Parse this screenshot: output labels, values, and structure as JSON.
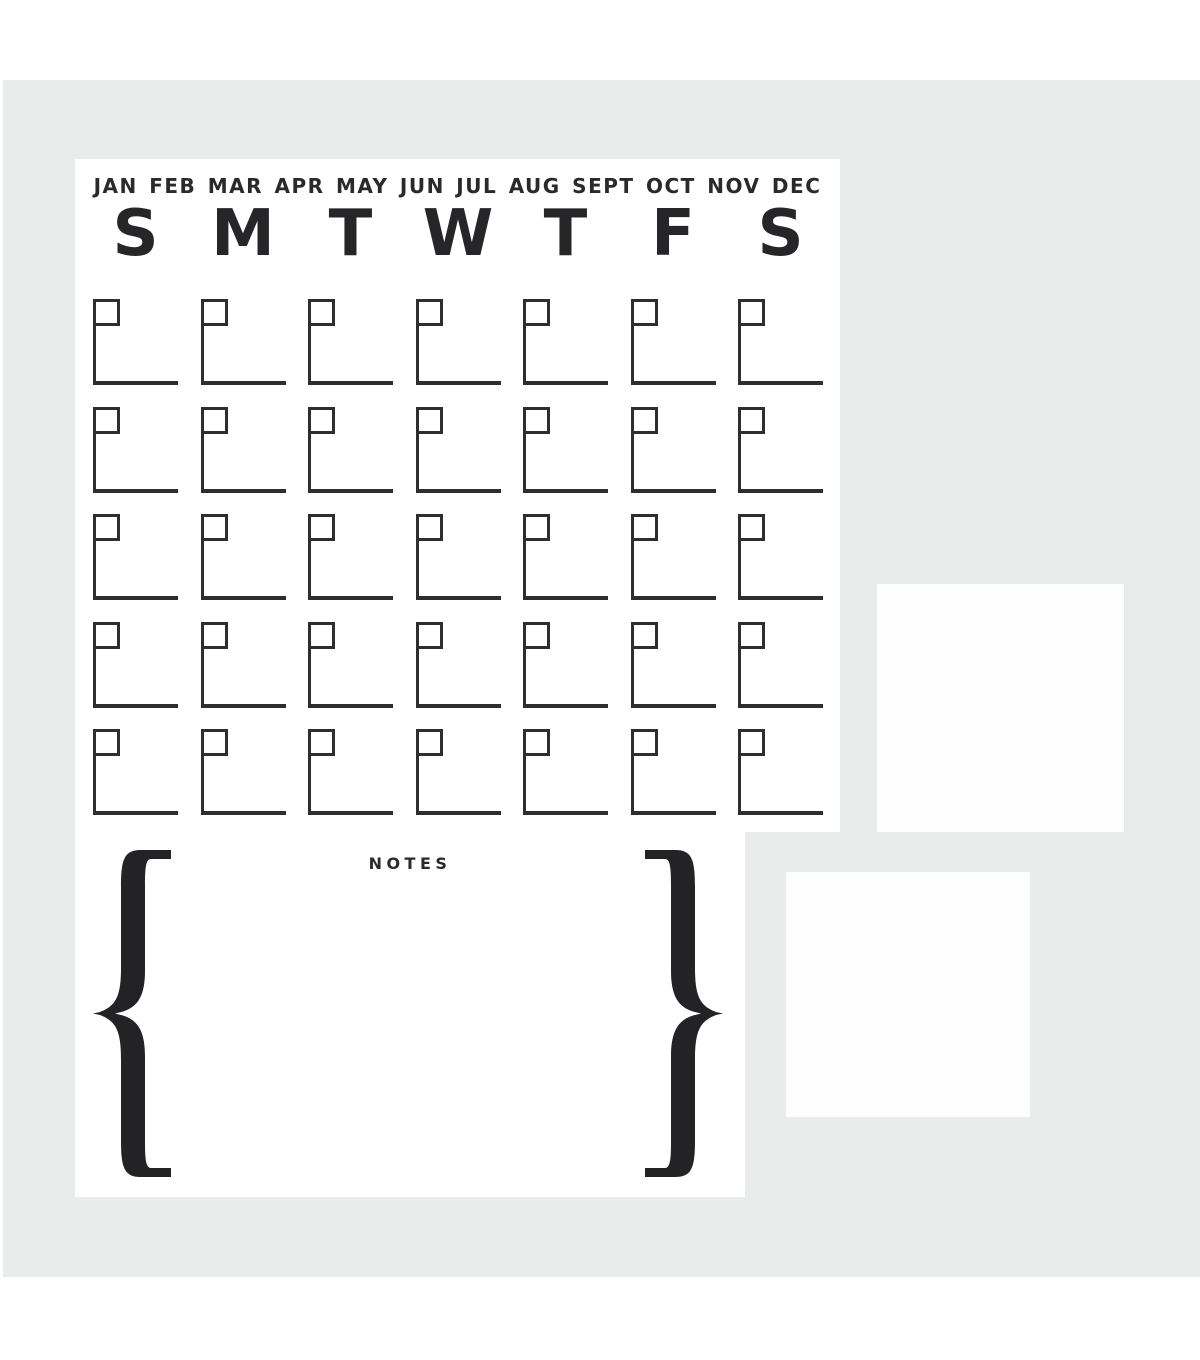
{
  "page": {
    "background_color": "#ffffff",
    "backdrop_color": "#eaecec",
    "ink_color": "#2e2d2f"
  },
  "calendar": {
    "months_label": "JAN FEB MAR APR MAY JUN JUL AUG SEPT OCT NOV DEC",
    "day_initials": [
      "S",
      "M",
      "T",
      "W",
      "T",
      "F",
      "S"
    ],
    "grid": {
      "rows": 5,
      "columns": 7
    }
  },
  "notes": {
    "label": "NOTES",
    "left_brace": "{",
    "right_brace": "}"
  }
}
